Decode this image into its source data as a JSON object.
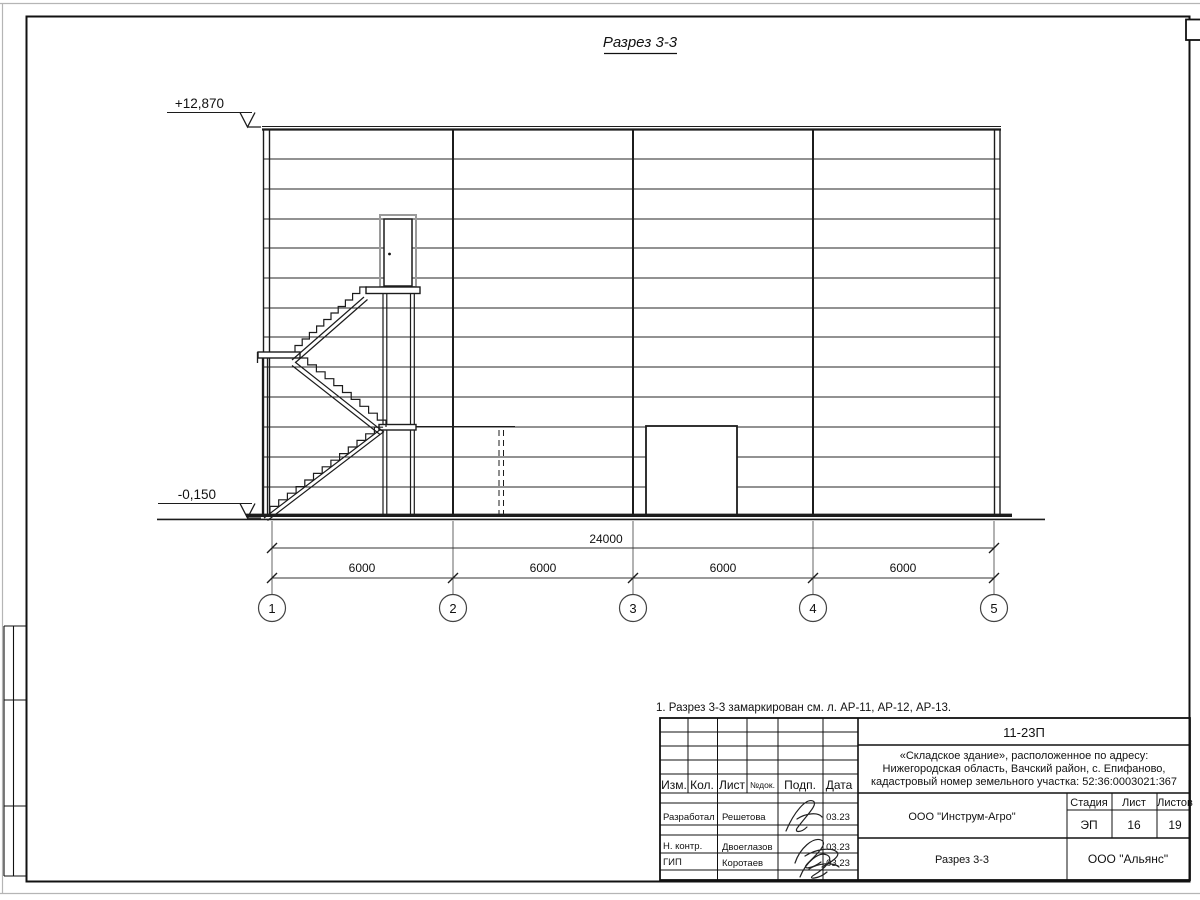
{
  "drawing": {
    "title": "Разрез 3-3",
    "elevation_top": "+12,870",
    "elevation_bottom": "-0,150",
    "note": "1. Разрез 3-3 замаркирован см. л. АР-11, АР-12, АР-13.",
    "dims": {
      "total": "24000",
      "spans": [
        "6000",
        "6000",
        "6000",
        "6000"
      ]
    },
    "axes": [
      "1",
      "2",
      "3",
      "4",
      "5"
    ]
  },
  "titleblock": {
    "doc_number": "11-23П",
    "address_lines": [
      "«Складское здание», расположенное по адресу:",
      "Нижегородская область, Вачский район, с. Епифаново,",
      "кадастровый номер земельного участка: 52:36:0003021:367"
    ],
    "header": {
      "izm": "Изм.",
      "kol": "Кол.",
      "list": "Лист",
      "ndoc": "№док.",
      "podp": "Подп.",
      "data": "Дата"
    },
    "sign_rows": [
      {
        "role": "Разработал",
        "name": "Решетова",
        "date": "03.23"
      },
      {
        "role": "Н. контр.",
        "name": "Двоеглазов",
        "date": "03.23"
      },
      {
        "role": "ГИП",
        "name": "Коротаев",
        "date": "03.23"
      }
    ],
    "company": "ООО \"Инструм-Агро\"",
    "stage_label": "Стадия",
    "sheet_label": "Лист",
    "sheets_label": "Листов",
    "stage": "ЭП",
    "sheet": "16",
    "sheets": "19",
    "drawing_name": "Разрез 3-3",
    "contractor": "ООО \"Альянс\""
  },
  "colors": {
    "line": "#1c1c1c",
    "light": "#9a9a9a",
    "page_edge": "#b5b5b5"
  }
}
